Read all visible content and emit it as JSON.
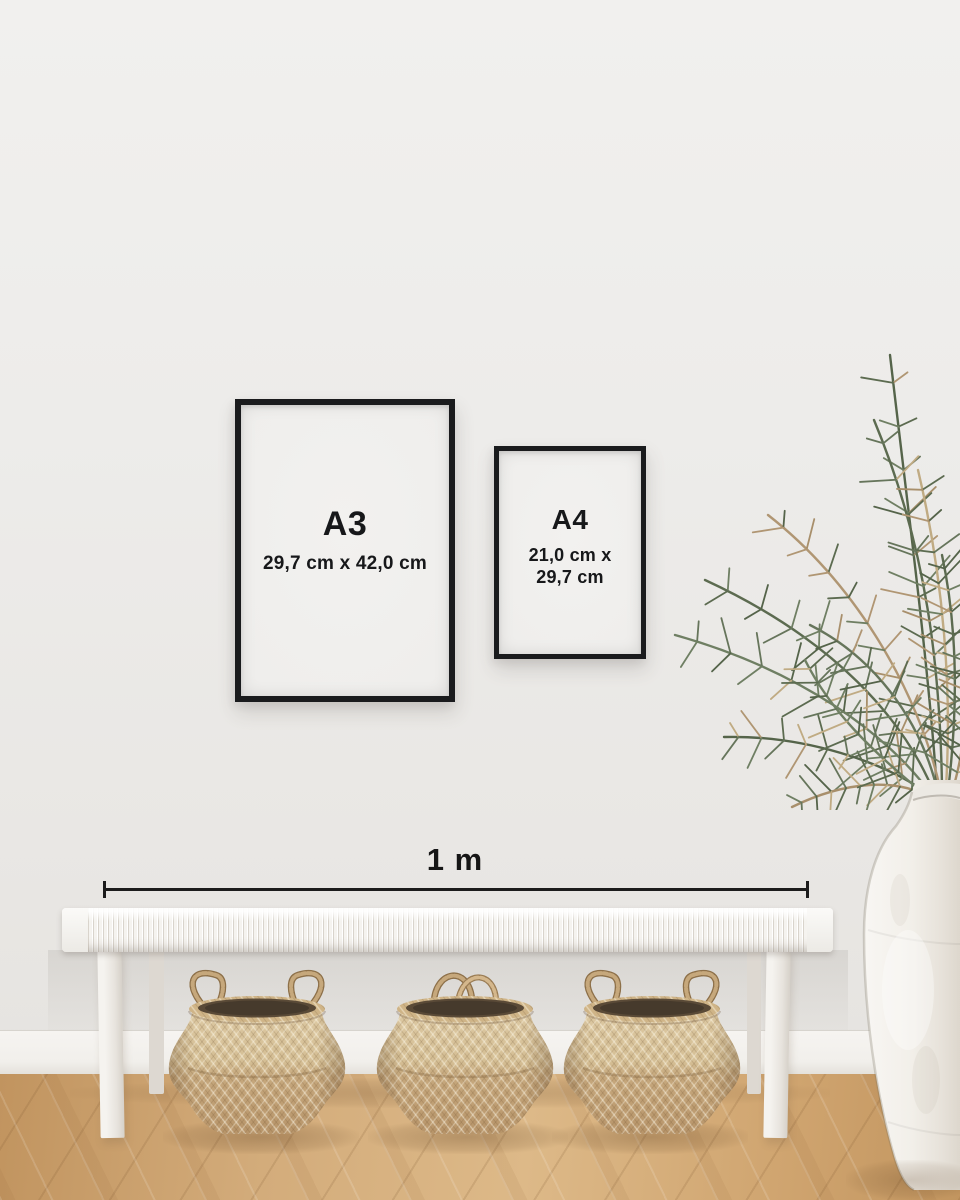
{
  "frames": {
    "a3": {
      "label": "A3",
      "size": "29,7 cm x 42,0 cm"
    },
    "a4": {
      "label": "A4",
      "size_line1": "21,0 cm x",
      "size_line2": "29,7 cm"
    }
  },
  "scale_bar": {
    "label": "1 m",
    "length_meters": 1
  },
  "scene_description": "Size-guide mockup: black A3 and A4 frames on a wall above a white woven bench, 1 m scale bar, three seagrass belly baskets, dried palm plant in a white ceramic vase, oak wood floor",
  "colors": {
    "wall": "#eceae6",
    "frame": "#1a1b1d",
    "paper": "#f0efed",
    "text": "#17181a",
    "scale_line": "#1c1c1c",
    "bench": "#f5f3ef",
    "basket": "#c9a97c",
    "basket_opening": "#4a3d2d",
    "floor": "#cfa571",
    "plant_green": "#5c6b50",
    "plant_dry": "#b09673",
    "vase": "#f2efe9"
  }
}
